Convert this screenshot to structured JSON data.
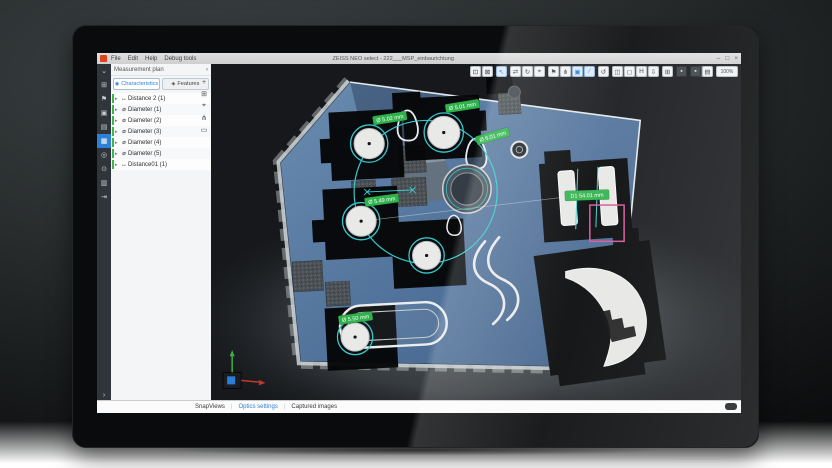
{
  "window": {
    "title": "ZEISS NEO select - 222___MSP_einbaurichtung",
    "menu": [
      "File",
      "Edit",
      "Help",
      "Debug tools"
    ],
    "controls": [
      {
        "name": "minimize",
        "glyph": "–"
      },
      {
        "name": "maximize",
        "glyph": "□"
      },
      {
        "name": "close",
        "glyph": "×"
      }
    ]
  },
  "sidebar": {
    "items": [
      {
        "name": "collapse",
        "glyph": "⌄",
        "active": false
      },
      {
        "name": "project",
        "glyph": "⊞",
        "active": false
      },
      {
        "name": "probe",
        "glyph": "⚑",
        "active": false
      },
      {
        "name": "alignment",
        "glyph": "▣",
        "active": false
      },
      {
        "name": "plan",
        "glyph": "▤",
        "active": false
      },
      {
        "name": "measure",
        "glyph": "▦",
        "active": true
      },
      {
        "name": "evaluate",
        "glyph": "◎",
        "active": false
      },
      {
        "name": "report",
        "glyph": "⊙",
        "active": false
      },
      {
        "name": "documents",
        "glyph": "▥",
        "active": false
      },
      {
        "name": "export",
        "glyph": "⇥",
        "active": false
      }
    ],
    "bottom_chevron": "›"
  },
  "panel": {
    "title": "Measurement plan",
    "chevron": "›",
    "tabs": [
      {
        "label": "Characteristics",
        "glyph": "◉",
        "active": true
      },
      {
        "label": "Features",
        "glyph": "◈",
        "active": false
      }
    ],
    "tree": [
      {
        "expander": "▸",
        "glyph": "↔",
        "label": "Distance 2 (1)"
      },
      {
        "expander": "▸",
        "glyph": "⌀",
        "label": "Diameter (1)"
      },
      {
        "expander": "▸",
        "glyph": "⌀",
        "label": "Diameter (2)"
      },
      {
        "expander": "▸",
        "glyph": "⌀",
        "label": "Diameter (3)"
      },
      {
        "expander": "▸",
        "glyph": "⌀",
        "label": "Diameter (4)"
      },
      {
        "expander": "▸",
        "glyph": "⌀",
        "label": "Diameter (5)"
      },
      {
        "expander": "▸",
        "glyph": "↔",
        "label": "Distance01 (1)"
      }
    ],
    "side_tools": [
      {
        "name": "add",
        "glyph": "+"
      },
      {
        "name": "duplicate",
        "glyph": "⊞"
      },
      {
        "name": "target",
        "glyph": "⌖"
      },
      {
        "name": "hierarchy",
        "glyph": "⋔"
      },
      {
        "name": "display",
        "glyph": "▭"
      }
    ]
  },
  "viewport": {
    "toolbar": [
      {
        "name": "fit-view",
        "glyph": "⊡",
        "active": false,
        "dark": false
      },
      {
        "name": "zoom-selection",
        "glyph": "⊠",
        "active": false,
        "dark": false
      },
      {
        "name": "select-cursor",
        "glyph": "↖",
        "active": true,
        "dark": false
      },
      {
        "name": "pan",
        "glyph": "⇄",
        "active": false,
        "dark": false
      },
      {
        "name": "orbit",
        "glyph": "↻",
        "active": false,
        "dark": false
      },
      {
        "name": "zoom-tool",
        "glyph": "⌖",
        "active": false,
        "dark": false
      },
      {
        "name": "flag",
        "glyph": "⚑",
        "active": false,
        "dark": false
      },
      {
        "name": "nodes",
        "glyph": "⋔",
        "active": false,
        "dark": false
      },
      {
        "name": "region",
        "glyph": "▣",
        "active": true,
        "dark": false
      },
      {
        "name": "draw",
        "glyph": "∕",
        "active": true,
        "dark": false
      },
      {
        "name": "refresh",
        "glyph": "↺",
        "active": false,
        "dark": false
      },
      {
        "name": "view-front",
        "glyph": "◫",
        "active": false,
        "dark": false
      },
      {
        "name": "view-top",
        "glyph": "◻",
        "active": false,
        "dark": false
      },
      {
        "name": "view-h",
        "glyph": "H",
        "active": false,
        "dark": false
      },
      {
        "name": "export-view",
        "glyph": "⇩",
        "active": false,
        "dark": false
      },
      {
        "name": "grid",
        "glyph": "⊞",
        "active": false,
        "dark": false
      },
      {
        "name": "shading-a",
        "glyph": "▪",
        "active": false,
        "dark": true
      },
      {
        "name": "shading-b",
        "glyph": "▪",
        "active": false,
        "dark": true
      },
      {
        "name": "snapshot-doc",
        "glyph": "▤",
        "active": false,
        "dark": false
      },
      {
        "name": "zoom-level",
        "glyph": "100%",
        "active": false,
        "dark": false
      }
    ]
  },
  "scene": {
    "labels": [
      {
        "text": "Ø 5.02 mm"
      },
      {
        "text": "Ø 5.01 mm"
      },
      {
        "text": "Ø 6.01 mm"
      },
      {
        "text": "Ø 5.49 mm"
      },
      {
        "text": "Ø 5.50 mm"
      },
      {
        "text": "D1 54.01 mm"
      }
    ]
  },
  "bottombar": {
    "tabs": [
      {
        "label": "SnapViews",
        "active": false
      },
      {
        "label": "Optics settings",
        "active": true
      },
      {
        "label": "Captured images",
        "active": false
      }
    ]
  },
  "colors": {
    "accent_blue": "#2e7fd6",
    "measurement_green": "#2fb24c",
    "measurement_teal": "#35c8cc",
    "selection_magenta": "#d6549b",
    "tree_status_green": "#3cb54a",
    "part_blue": "#53749c"
  }
}
